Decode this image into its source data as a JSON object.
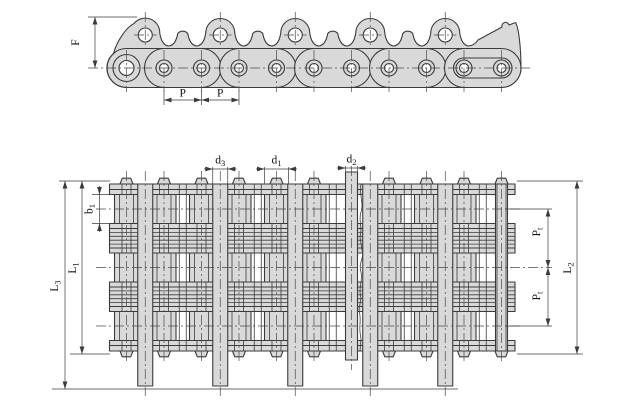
{
  "colors": {
    "background": "#ffffff",
    "part_fill": "#d9d9d9",
    "outline": "#3b3b3b",
    "dimension_lines": "#3b3b3b",
    "text": "#111111"
  },
  "labels": {
    "F": {
      "base": "F"
    },
    "P_left": {
      "base": "P"
    },
    "P_right": {
      "base": "P"
    },
    "d3": {
      "base": "d",
      "sub": "3"
    },
    "d1": {
      "base": "d",
      "sub": "1"
    },
    "d2": {
      "base": "d",
      "sub": "2"
    },
    "b1": {
      "base": "b",
      "sub": "1"
    },
    "L1": {
      "base": "L",
      "sub": "1"
    },
    "L3": {
      "base": "L",
      "sub": "3"
    },
    "L2": {
      "base": "L",
      "sub": "2"
    },
    "Pt_upper": {
      "base": "P",
      "sub": "t"
    },
    "Pt_lower": {
      "base": "P",
      "sub": "t"
    }
  }
}
